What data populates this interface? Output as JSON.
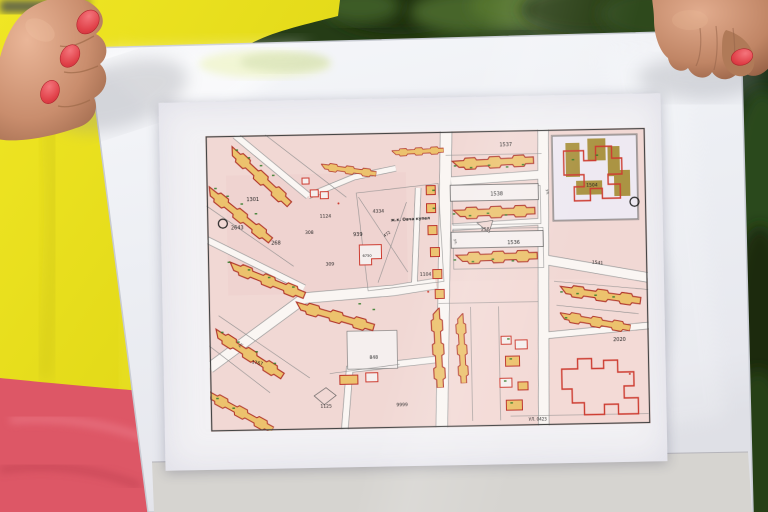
{
  "map": {
    "district_label": "ж.к. Овча купел",
    "street_label": "ул.",
    "road_label": "УЛ. 0423",
    "parcels": [
      "1301",
      "2643",
      "268",
      "308",
      "309",
      "1124",
      "939",
      "472",
      "4334",
      "6750",
      "1104",
      "1537",
      "1538",
      "258",
      "1536",
      "1541",
      "1504",
      "2020",
      "848",
      "1125",
      "9999",
      "1767"
    ]
  },
  "colors": {
    "map_background_pink": "#f2d8d4",
    "building_fill_orange": "#eec269",
    "building_outline_red": "#b5352a",
    "highlight_red": "#d23b2f",
    "school_building_olive": "#ac9440",
    "annotation_green": "#2f7d26",
    "street_white": "#faf6f3",
    "nail_polish_red": "#e04048",
    "jacket_yellow": "#e6de1d",
    "garment_pink": "#dd5766",
    "foliage_green": "#2a421d",
    "sheet_white": "#eef0f5"
  }
}
